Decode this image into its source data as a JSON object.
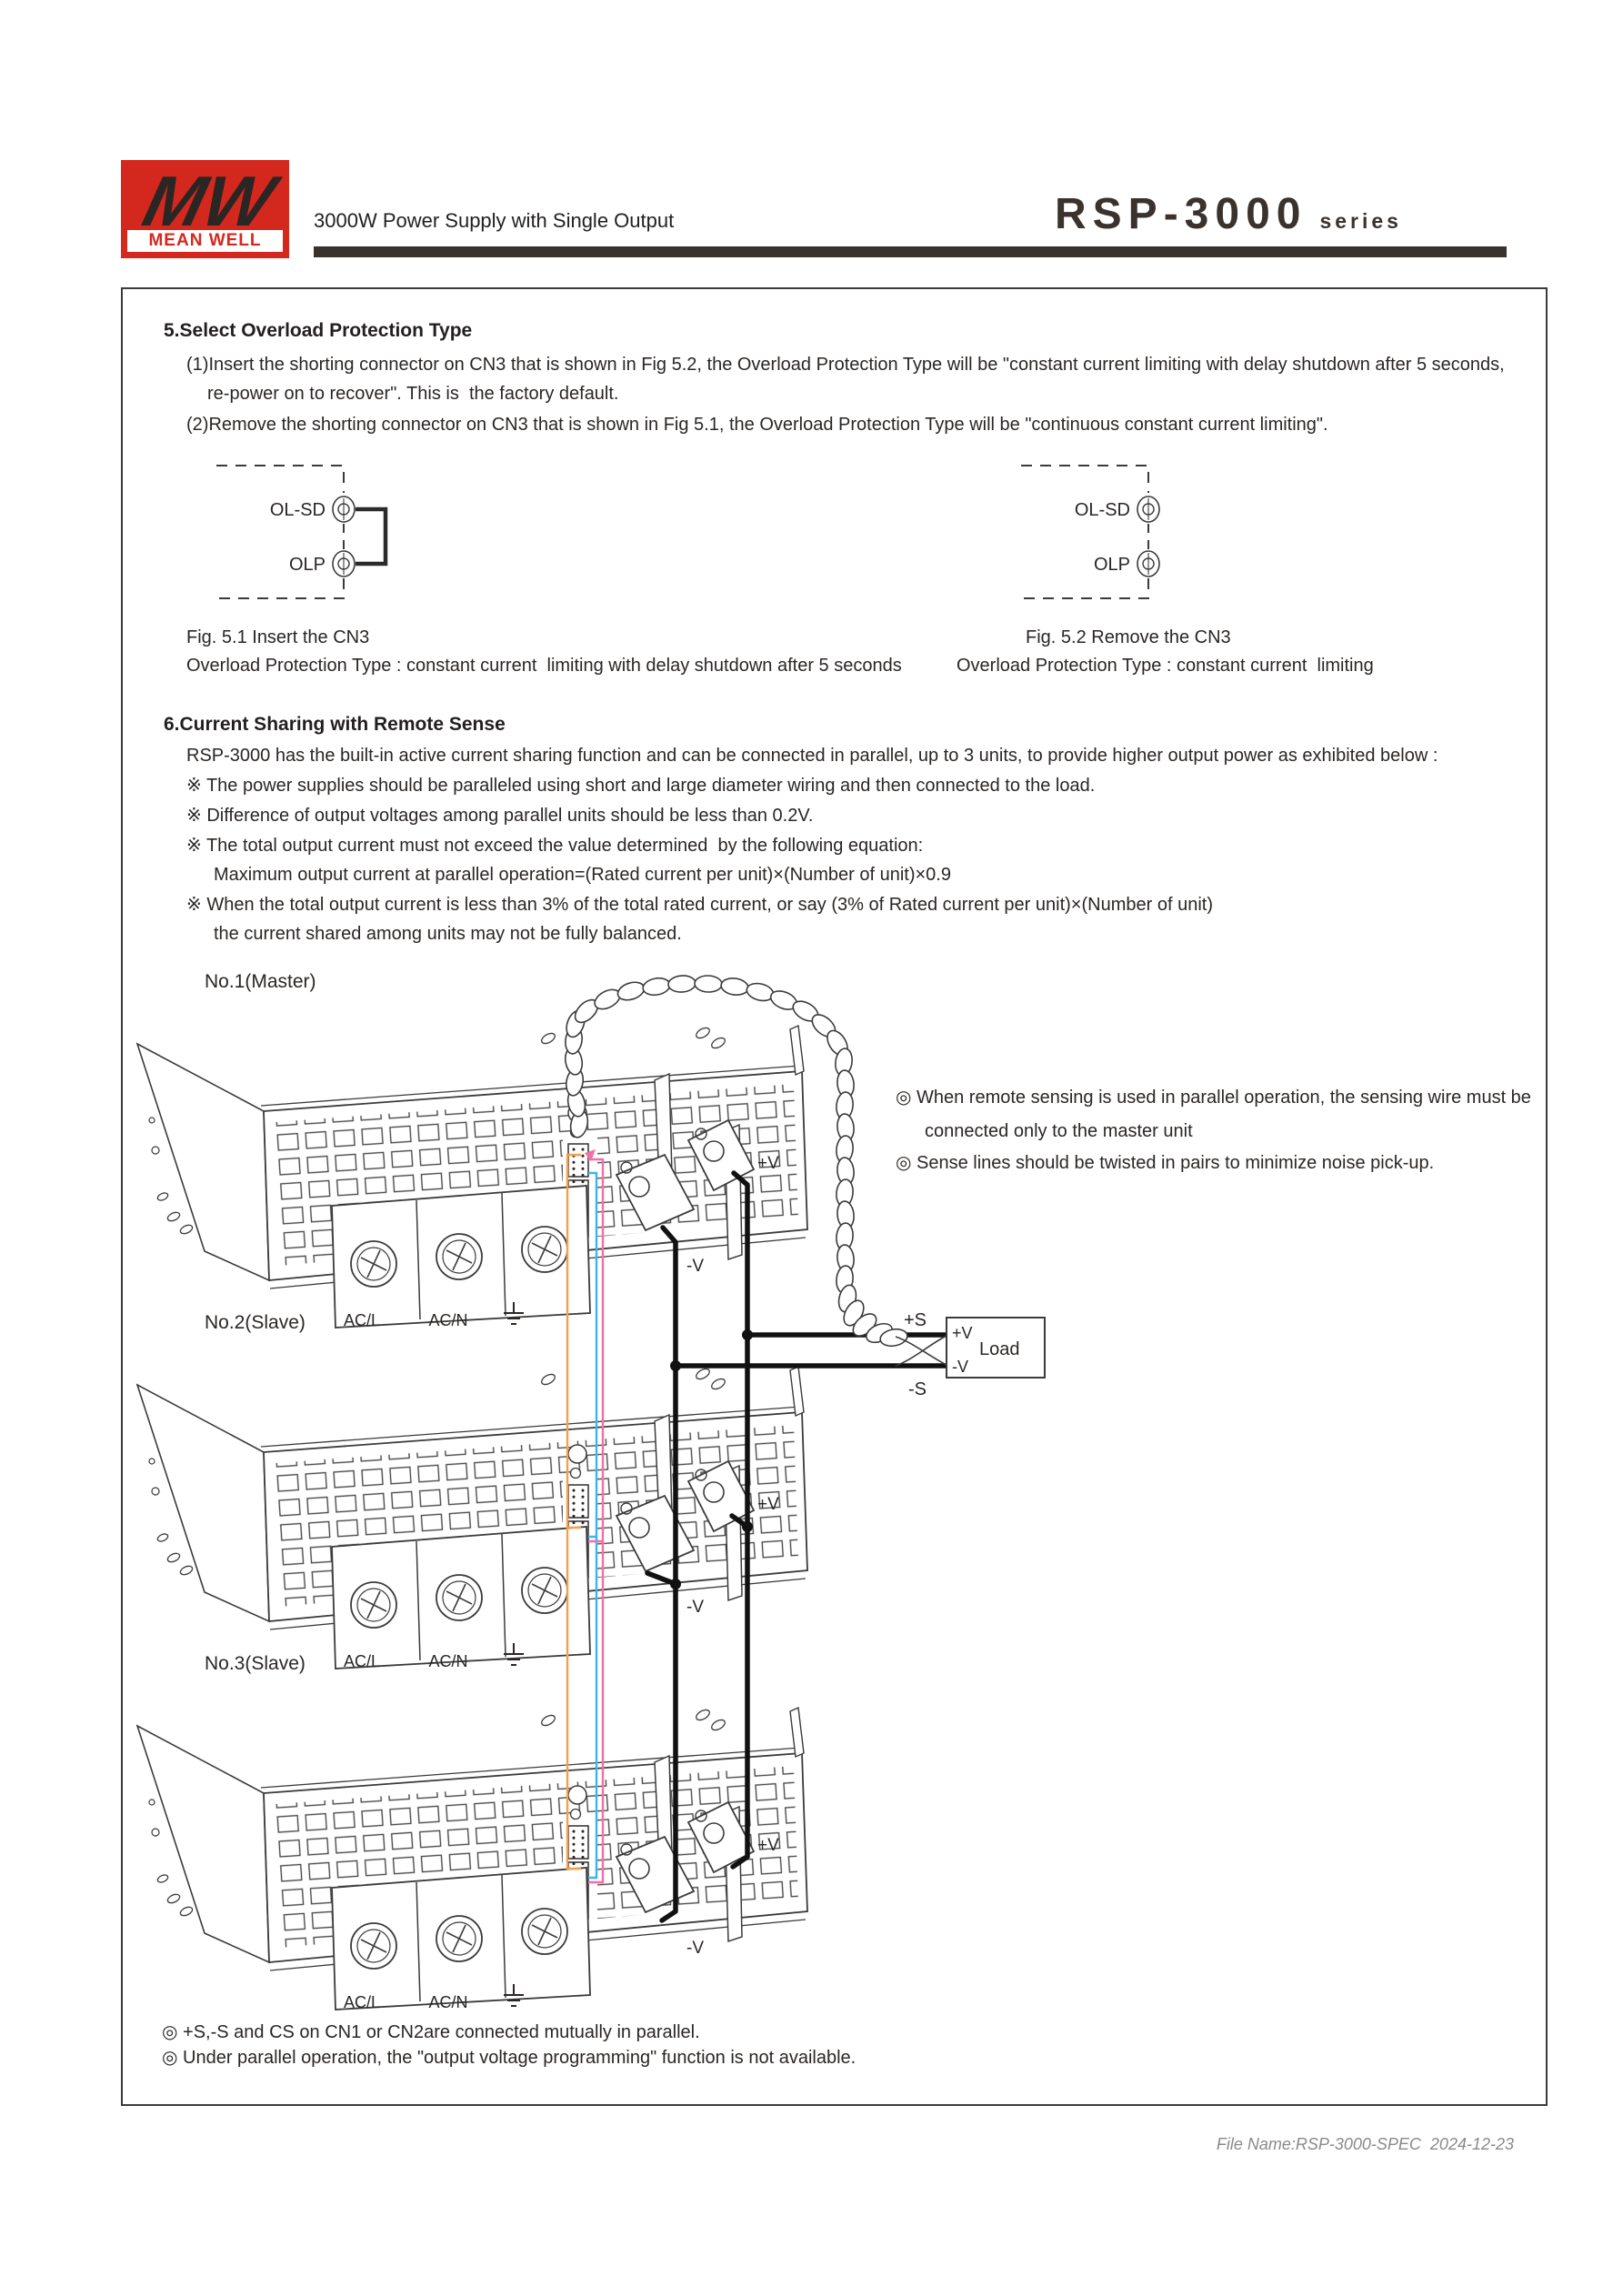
{
  "header": {
    "logo": {
      "mw": "MW",
      "brand": "MEAN WELL"
    },
    "title": "3000W Power Supply with Single Output",
    "series_name": "RSP-3000",
    "series_suffix": "series"
  },
  "section5": {
    "heading": "5.Select Overload Protection Type",
    "item1_line1": "(1)Insert the shorting connector on CN3 that is shown in Fig 5.2, the Overload Protection Type will be \"constant current limiting with delay shutdown after 5 seconds,",
    "item1_line2": "re-power on to recover\". This is  the factory default.",
    "item2": "(2)Remove the shorting connector on CN3 that is shown in Fig 5.1, the Overload Protection Type will be \"continuous constant current limiting\".",
    "fig51": {
      "terminal1": "OL-SD",
      "terminal2": "OLP",
      "caption1": "Fig. 5.1 Insert the CN3",
      "caption2": "Overload Protection Type : constant current  limiting with delay shutdown after 5 seconds"
    },
    "fig52": {
      "terminal1": "OL-SD",
      "terminal2": "OLP",
      "caption1": "Fig. 5.2 Remove the CN3",
      "caption2": "Overload Protection Type : constant current  limiting"
    }
  },
  "section6": {
    "heading": "6.Current Sharing with Remote Sense",
    "intro": "RSP-3000 has the built-in active current sharing function and can be connected in parallel, up to 3 units, to provide higher output power as exhibited below :",
    "bullet1": "※ The power supplies should be paralleled using short and large diameter wiring and then connected to the load.",
    "bullet2": "※ Difference of output voltages among parallel units should be less than 0.2V.",
    "bullet3": "※ The total output current must not exceed the value determined  by the following equation:",
    "bullet3_formula": "Maximum output current at parallel operation=(Rated current per unit)×(Number of unit)×0.9",
    "bullet4_line1": "※ When the total output current is less than 3% of the total rated current, or say (3% of Rated current per unit)×(Number of unit)",
    "bullet4_line2": "the current shared among units may not be fully balanced."
  },
  "diagram": {
    "units": [
      {
        "label": "No.1(Master)"
      },
      {
        "label": "No.2(Slave)"
      },
      {
        "label": "No.3(Slave)"
      }
    ],
    "ac_l": "AC/L",
    "ac_n": "AC/N",
    "v_plus": "+V",
    "v_minus": "-V",
    "s_plus": "+S",
    "s_minus": "-S",
    "load": {
      "label": "Load",
      "v_plus": "+V",
      "v_minus": "-V"
    },
    "notes": {
      "note1_line1": "◎ When remote sensing is used in parallel operation, the sensing wire must be",
      "note1_line2": "connected only to the master unit",
      "note2": "◎ Sense lines should be twisted in pairs to minimize noise pick-up."
    },
    "wire_colors": {
      "orange": "#F5A04A",
      "blue": "#3FB6E8",
      "pink": "#F36FA8"
    }
  },
  "footnotes": {
    "note1": "◎ +S,-S and CS on CN1 or CN2are connected mutually in parallel.",
    "note2": "◎ Under parallel operation, the \"output voltage programming\" function is not available."
  },
  "footer": {
    "file_name": "File Name:RSP-3000-SPEC  2024-12-23"
  }
}
